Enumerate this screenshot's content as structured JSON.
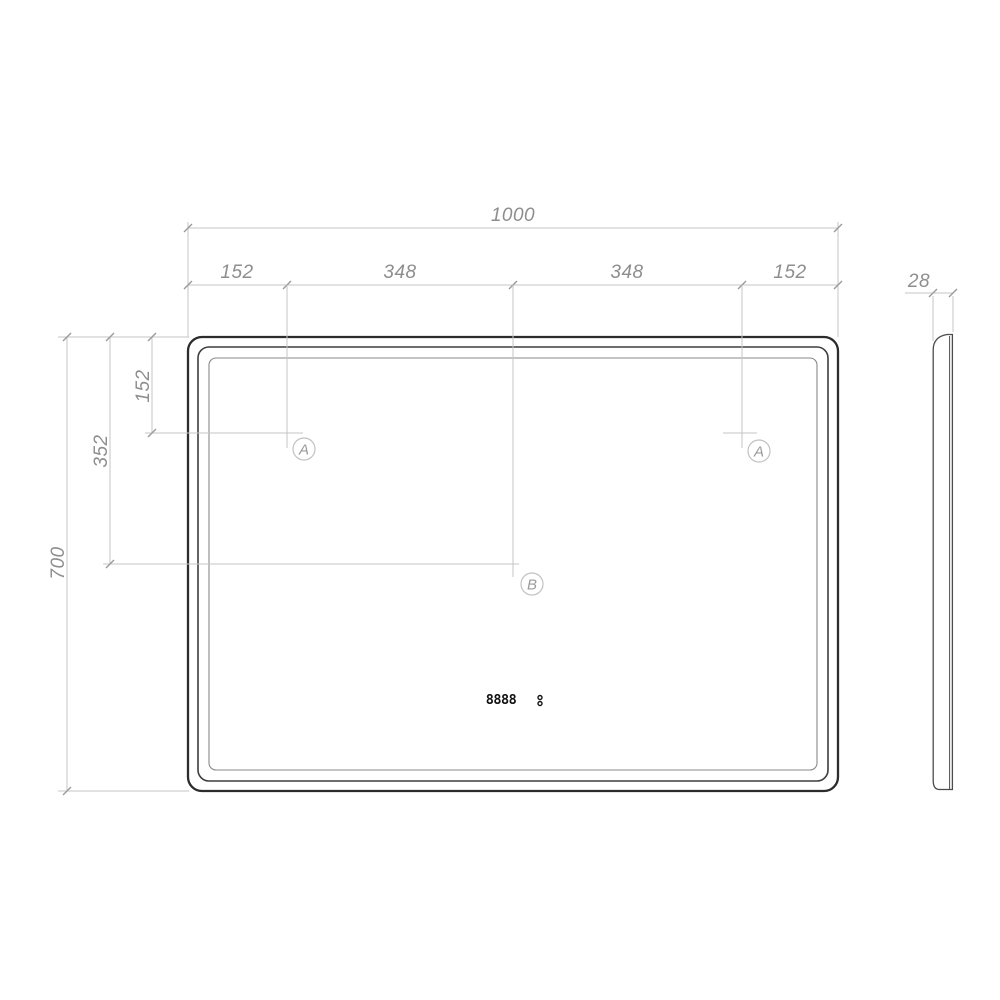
{
  "front_view": {
    "dim_width_total": "1000",
    "dim_width_segments": [
      "152",
      "348",
      "348",
      "152"
    ],
    "dim_height_total": "700",
    "dim_height_to_center": "352",
    "dim_height_to_led_line": "152",
    "marker_a_left": "A",
    "marker_a_right": "A",
    "marker_b": "B",
    "clock_digits": "8888"
  },
  "side_view": {
    "dim_thickness": "28"
  },
  "colors": {
    "outline_dark": "#2c2c2c",
    "outline_inner": "#8a8a8a",
    "dimension_line": "#c6c6c6",
    "dimension_text": "#8e8e8e",
    "marker_text": "#9a9a9a",
    "clock_text": "#121212",
    "background": "#ffffff"
  }
}
